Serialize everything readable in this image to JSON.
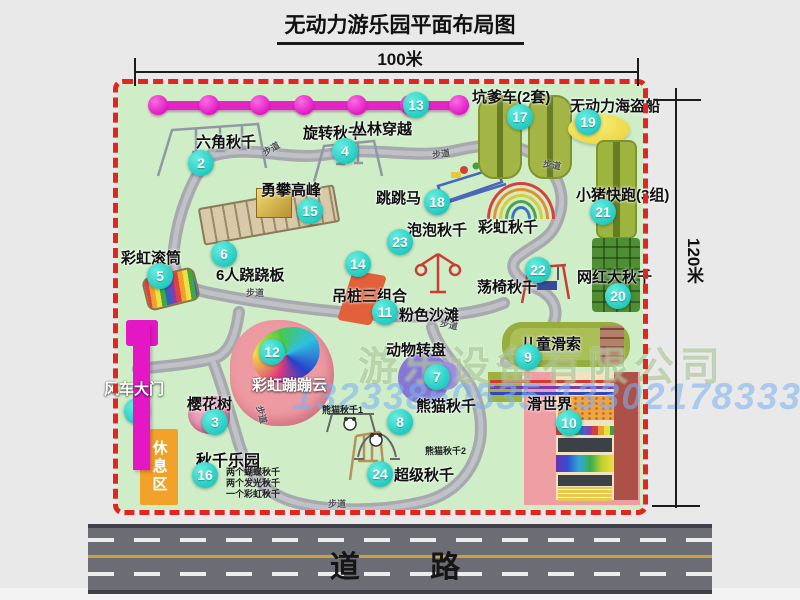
{
  "title": "无动力游乐园平面布局图",
  "dims": {
    "top": "100米",
    "right": "120米"
  },
  "road": {
    "label": "道 路"
  },
  "watermark": {
    "company": "游乐设备有限公司",
    "phone": "13233860535 13302178333"
  },
  "map": {
    "rest_area_label": "休息区",
    "trail_label": "步道",
    "rainbow_swing_label": "彩虹秋千",
    "items": [
      {
        "num": "1",
        "label": "风车大门"
      },
      {
        "num": "2",
        "label": "六角秋千"
      },
      {
        "num": "3",
        "label": "樱花树"
      },
      {
        "num": "4",
        "label": "旋转秋千"
      },
      {
        "num": "5",
        "label": "彩虹滚筒"
      },
      {
        "num": "6",
        "label": "6人跷跷板"
      },
      {
        "num": "7",
        "label": "动物转盘"
      },
      {
        "num": "8",
        "label": "熊猫秋千",
        "sub1": "熊猫秋千1",
        "sub2": "熊猫秋千2"
      },
      {
        "num": "9",
        "label": "儿童滑索"
      },
      {
        "num": "10",
        "label": "滑世界"
      },
      {
        "num": "11",
        "label": "粉色沙滩"
      },
      {
        "num": "12",
        "label": "彩虹蹦蹦云"
      },
      {
        "num": "13",
        "label": "丛林穿越"
      },
      {
        "num": "14",
        "label": "吊桩三组合"
      },
      {
        "num": "15",
        "label": "勇攀高峰"
      },
      {
        "num": "16",
        "label": "秋千乐园",
        "notes": [
          "两个蝴蝶秋千",
          "两个发光秋千",
          "一个彩虹秋千"
        ]
      },
      {
        "num": "17",
        "label": "坑爹车(2套)"
      },
      {
        "num": "18",
        "label": "跳跳马"
      },
      {
        "num": "19",
        "label": "无动力海盗船"
      },
      {
        "num": "20",
        "label": "网红大秋千"
      },
      {
        "num": "21",
        "label": "小猪快跑(3组)"
      },
      {
        "num": "22",
        "label": "荡椅秋千"
      },
      {
        "num": "23",
        "label": "泡泡秋千"
      },
      {
        "num": "24",
        "label": "超级秋千"
      }
    ]
  },
  "colors": {
    "map_bg": "#cfeec8",
    "border_dash": "#e22521",
    "badge": "#23ccc2",
    "jungle_line": "#e524c6",
    "gate": "#e318c4",
    "rest_area": "#f2a229",
    "road": "#6c6c74",
    "road_center_line": "#c9a43e"
  }
}
